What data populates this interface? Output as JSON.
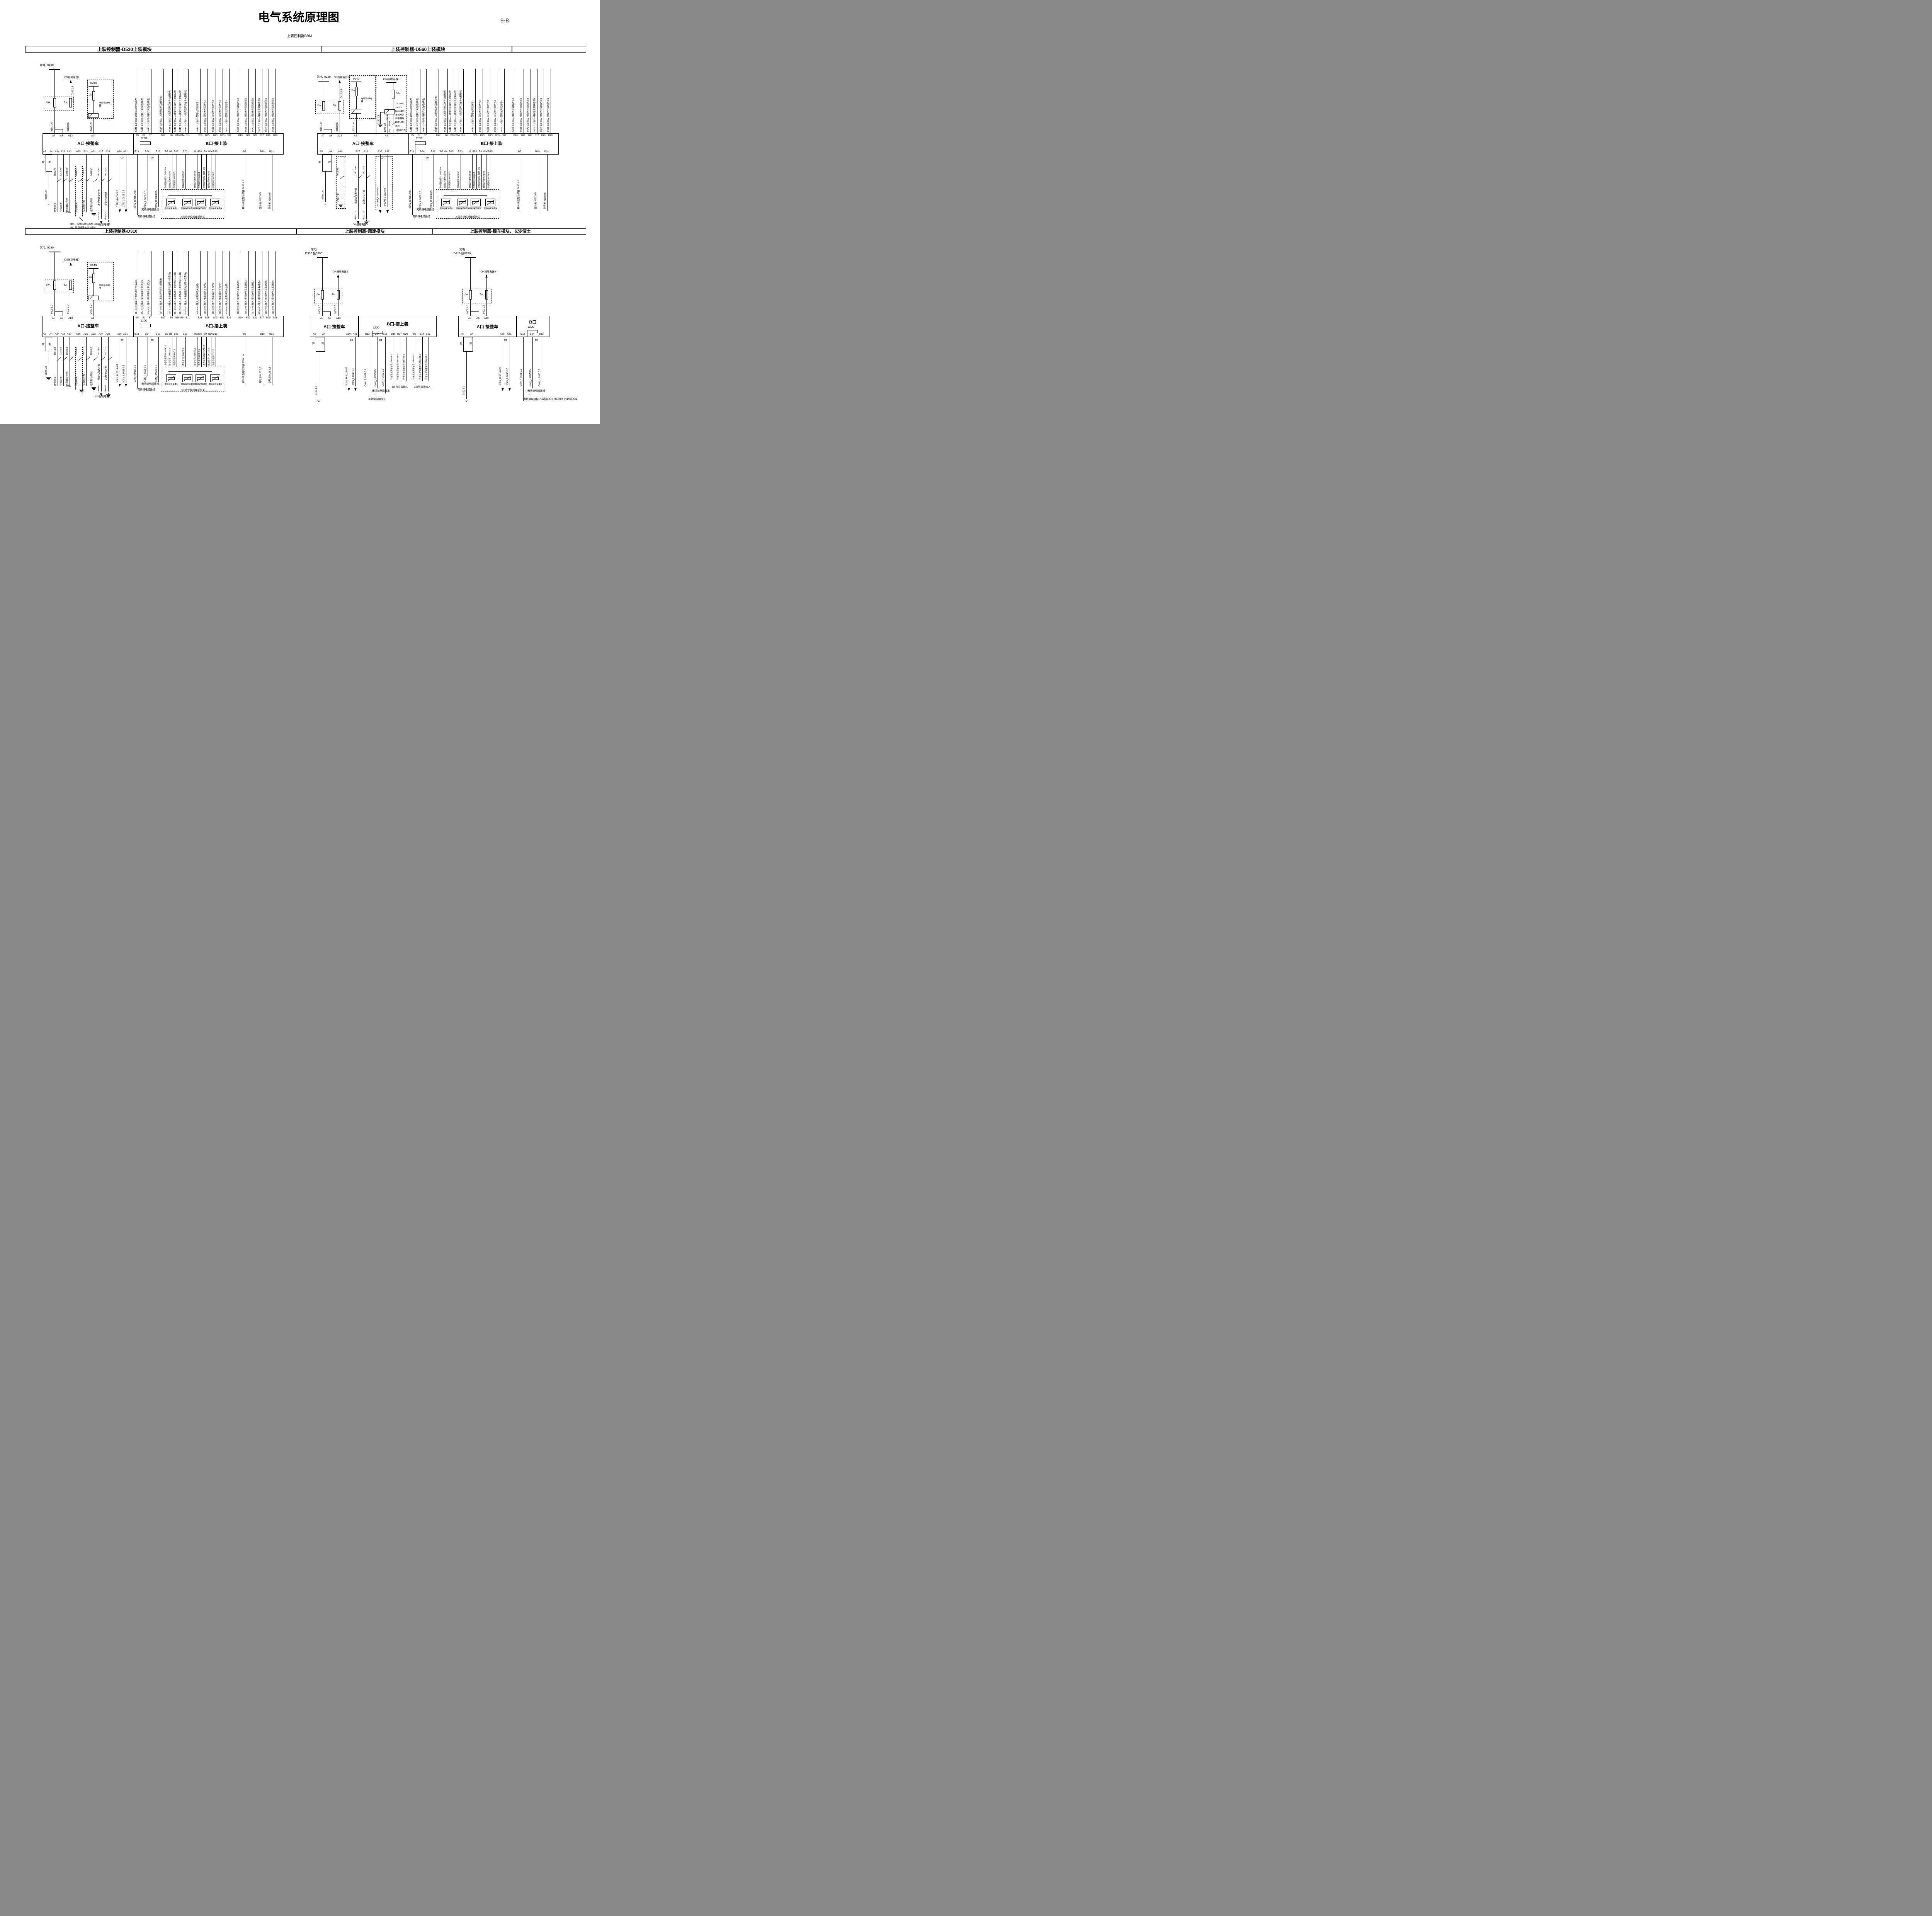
{
  "page": {
    "title": "电气系统原理图",
    "page_number": "9-8",
    "subtitle": "上装控制器BBM",
    "footer": "3700001-94209. H190904"
  },
  "top_band": [
    "上装控制器-D530上装模块",
    "上装控制器-D560上装模块",
    ""
  ],
  "bottom_band": [
    "上装控制器-D310",
    "上装控制器-调速模块",
    "上装控制器-锁车模块、长沙渣土"
  ],
  "fuses": {
    "f10": "10A",
    "f5": "5A"
  },
  "relay2": "ON挡继电器2",
  "relay1": "ON挡继电器1",
  "horn": {
    "top": "0240",
    "fuse": "10A",
    "name": "电喇叭继电器",
    "wire": "2022 1.0"
  },
  "ground_label": "地",
  "ground_wire": "0100 1.0",
  "resistor": "120Ω",
  "terminal_notes": {
    "none": "无终端电阻接法",
    "with": "有终端电阻接法",
    "dots": "· · ·"
  },
  "b_signals": [
    {
      "label": "9641 1.0  输出-驻车制动信号(高边)",
      "pin": "B4"
    },
    {
      "label": "9642 1.0  输出-空挡开关信号(低边)",
      "pin": "B1"
    },
    {
      "label": "9643 0.5  输出-倒挡开关信号(低边)",
      "pin": "B7"
    },
    {
      "label": "9644 0.5  输入-上装喇叭开关(低有效)",
      "pin": "B27"
    },
    {
      "label": "9645 1.0  输入-上装旋钮开关信号1(低有效)",
      "pin": "B5"
    },
    {
      "label": "9646 0.5  输入-上装旋钮开关信号2(低有效)",
      "pin": "B16"
    },
    {
      "label": "9647 0.5  输入-上装旋钮开关信号3(低有效)",
      "pin": "B14"
    },
    {
      "label": "9648 0.5  输入-上装旋钮开关信号4(低有效)",
      "pin": "B11"
    },
    {
      "label": "9649 0.5  输入-低有效开关信号1",
      "pin": "B26"
    },
    {
      "label": "9650 0.5  输入-低有效开关信号2",
      "pin": "B25"
    },
    {
      "label": "9651 0.5  输入-低有效开关信号3",
      "pin": "B23"
    },
    {
      "label": "9652 0.5  输入-低有效开关信号4",
      "pin": "B33"
    },
    {
      "label": "9653 0.5  输入-低有效开关信号5",
      "pin": "B32"
    },
    {
      "label": "9654 0.5  输入-模拟信号采集通道1",
      "pin": "B10"
    },
    {
      "label": "9655 0.5  输入-模拟信号采集通道2",
      "pin": "B22"
    },
    {
      "label": "9672 0.5  输入-模拟信号采集通道3",
      "pin": "B21"
    },
    {
      "label": "9656 0.5  输入-模拟信号采集通道4",
      "pin": "B17"
    },
    {
      "label": "9657 0.5  输入-模拟信号采集通道5",
      "pin": "B29"
    },
    {
      "label": "9658 0.5  输入-模拟信号采集通道6",
      "pin": "B28"
    }
  ],
  "sensor_wires": [
    {
      "label": "传感器电源5V 9664 1.0",
      "pin": "B2"
    },
    {
      "label": "模拟信号1 9665 0.5",
      "pin": "B8"
    },
    {
      "label": "传感器地 9666 0.5",
      "pin": "B35"
    },
    {
      "label": "模拟信号2 9667 0.5",
      "pin": "B20"
    },
    {
      "label": "模拟信号3 9668 0.5",
      "pin": "B18"
    },
    {
      "label": "传感器地 9669 0.5",
      "pin": "B6"
    },
    {
      "label": "传感器电源5V 9670 0.5",
      "pin": "B9"
    },
    {
      "label": "模拟信号4 9671 0.5",
      "pin": "B30"
    },
    {
      "label": "传感器地 9673 0.5",
      "pin": "B15"
    }
  ],
  "sensor_boxes": [
    "模拟信号采集1",
    "模拟信号采集2",
    "模拟信号采集3",
    "模拟信号采集4"
  ],
  "sensor_box_label": "上装系统传感器或开关",
  "b_outputs": [
    {
      "label": "输出-高边驱动预留 9659 1.0",
      "pin": "B3"
    },
    {
      "label": "驱动地  0197 0.5",
      "pin": "B19"
    },
    {
      "label": "信号地  0198 0.5",
      "pin": "B31"
    }
  ],
  "can_b": [
    {
      "label": "CAN_R  9661 0.5",
      "pin": "B13"
    },
    {
      "label": "CAN_L  9662 0.5",
      "pin": "B24"
    },
    {
      "label": "CAN_H  9663 0.5",
      "pin": "B12"
    }
  ],
  "can_b_small": [
    {
      "label": "CAN_R  9651 0.5",
      "pin": "B13"
    },
    {
      "label": "CAN_L  9652 0.5",
      "pin": "B24"
    },
    {
      "label": "CAN_H  9653 0.5",
      "pin": "B12"
    }
  ],
  "can_a": [
    {
      "label": "CAN_H  0014 0.5",
      "pin": "A30"
    },
    {
      "label": "CAN_L  0015 0.5",
      "pin": "A31"
    }
  ],
  "pcan": [
    {
      "label": "PCAN_H  5011 0.5",
      "pin": "A30"
    },
    {
      "label": "PCAN_L  5012 0.5",
      "pin": "A31"
    }
  ],
  "a_switches": [
    {
      "pin": "A34",
      "wire": "1501 0.5",
      "name": "取力开关"
    },
    {
      "pin": "A18",
      "wire": "0212 0.5",
      "name": "空挡开关"
    },
    {
      "pin": "A10",
      "wire": "1302 0.5",
      "name": "危险警报开关",
      "extra": "0250"
    },
    {
      "pin": "A35",
      "wire": "0603 0.5",
      "name": "倒挡开关"
    },
    {
      "pin": "A21",
      "wire": "1102 0.5",
      "name": "位置灯开关"
    },
    {
      "pin": "A22",
      "wire": "1408 0.5",
      "name": "驻车制动开关"
    },
    {
      "pin": "A27",
      "wire": "9612 0.5",
      "name": "发动机限速开关",
      "tail": "0209 0.5"
    },
    {
      "pin": "A29",
      "wire": "9611 0.5",
      "name": "定速PTO开关",
      "tail": "0100 0.5"
    }
  ],
  "speed_requests": [
    {
      "label": "转速设定请求信号1 9646 0.5"
    },
    {
      "label": "转速设定请求信号2 9644 0.5"
    },
    {
      "label": "转速设定请求信号3 9649 0.5"
    }
  ],
  "speed_captions": [
    "3路高有效输入",
    "3路低有效输入"
  ],
  "modules": {
    "d530": {
      "source": "常电  0290",
      "w1": "9601 1.0",
      "w2": "9602 0.5",
      "pre2": "0209 0.5",
      "connA": "A口-接整车",
      "connB": "B口-接上装",
      "note1": "康机，取倒挡继电器后 0603",
      "note2": "4H，取倒挡开关后  0600"
    },
    "d560": {
      "source": "常电  0220",
      "w1": "9601 1.0",
      "w2": "9602 0.5",
      "pre2": "0412 0.5",
      "connA": "A口-接整车",
      "connB": "B口-接上装",
      "neutral": {
        "wire": "4013 0.5",
        "name": "空挡开关"
      },
      "eng": {
        "wire": "9612 0.5",
        "name": "发动机限速开关",
        "tail": "0412 0.5"
      },
      "pto": {
        "wire": "9611 0.5",
        "name": "定速PTO开关",
        "tail": "0100 0.5"
      },
      "kill": {
        "f5": "5A",
        "w0416": "0416 1.0",
        "w0150": "0150 0.5",
        "w1005": "1005 1.0",
        "w1004": "1004 1.0",
        "w1003": "1003 1.0",
        "switch": "熄火开关",
        "eecu": "接EECU",
        "note": [
          "3700001",
          "-94201",
          "ks1x改制",
          "增加常闭",
          "继电器控",
          "制发动机",
          "熄火"
        ]
      }
    },
    "d310": {
      "source": "常电  0290",
      "w1": "9601 1.0",
      "w2": "9602 0.5",
      "connA": "A口-接整车",
      "connB": "B口-接上装",
      "note1": "康机"
    },
    "speed": {
      "source1": "常电",
      "source2": "D530 接0290",
      "w1": "9601 1.0",
      "w2": "9602 0.5",
      "connA": "A口-接整车",
      "connB": "B口-接上装"
    },
    "lock": {
      "source1": "常电",
      "source2": "D310 接0290",
      "w1": "9601 1.0",
      "w2": "9602 0.5",
      "connA": "A口-接整车",
      "connB": "B口"
    }
  }
}
